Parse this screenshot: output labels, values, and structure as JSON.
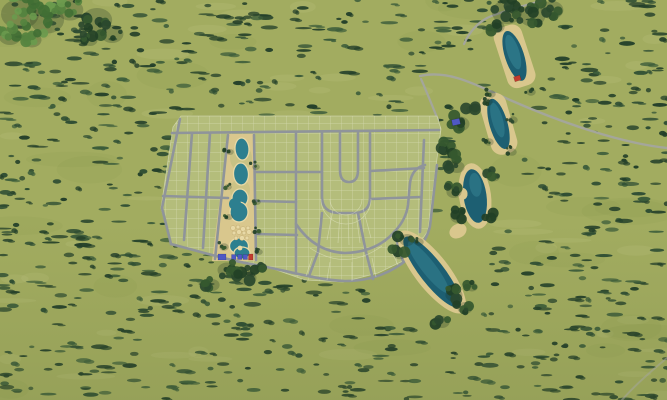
{
  "scene": {
    "type": "aerial-3d-masterplan-render",
    "description": "Aerial rendering of a residential masterplan: gridded housing lots with curved loop streets, a central lagoon amenity strip with pools and cabana buildings, a chain of four sand-edged lakes to the northeast, a winding access road, all surrounded by scrubby green fields",
    "colors": {
      "grass_base": "#a2ac60",
      "grass_light": "#c7cd8d",
      "grass_shadow": "#86944e",
      "bush_dark": "#24402a",
      "bush_mid": "#2e4d33",
      "bush_soft": "#3c5c3a",
      "tree_lush": "#55833f",
      "tree_lush_light": "#6a9a4d",
      "tree_dark": "#2a482e",
      "tree_shadow": "#1b2f1f",
      "site_grass": "#b4bd7b",
      "lot_line": "#eef0d8",
      "road_gray": "#8f949a",
      "external_road": "#a4a69b",
      "sand": "#d9c78d",
      "sand_light": "#e8d9a6",
      "water_deep": "#1d5f72",
      "water_mid": "#2d7f8f",
      "water_light": "#49a0ab",
      "roof_blue": "#4f58c4",
      "roof_red": "#c23b2e"
    },
    "site": {
      "name": "residential-development",
      "lot_blocks": 6,
      "amenity_strip": {
        "name": "lagoon-park-strip",
        "pools": 4,
        "sand_cabana_pads": 11,
        "buildings": {
          "blue_roof_count": 4,
          "red_roof_count": 1
        }
      },
      "clubhouse": {
        "roof": "blue"
      }
    },
    "water_features": [
      {
        "name": "north-pond",
        "shape": "oval",
        "beach": true,
        "building_roof": "red"
      },
      {
        "name": "upper-lake",
        "shape": "oblong",
        "beach": true
      },
      {
        "name": "middle-lake",
        "shape": "kidney",
        "beach": true
      },
      {
        "name": "south-lake",
        "shape": "large-oblong",
        "beach": true
      }
    ],
    "roads": {
      "internal": [
        "top-collector",
        "left-boundary",
        "bottom-boundary",
        "grid-streets",
        "u-loop-streets",
        "arc-street"
      ],
      "external": [
        "winding-access-road",
        "north-spur",
        "southeast-trace"
      ]
    }
  }
}
